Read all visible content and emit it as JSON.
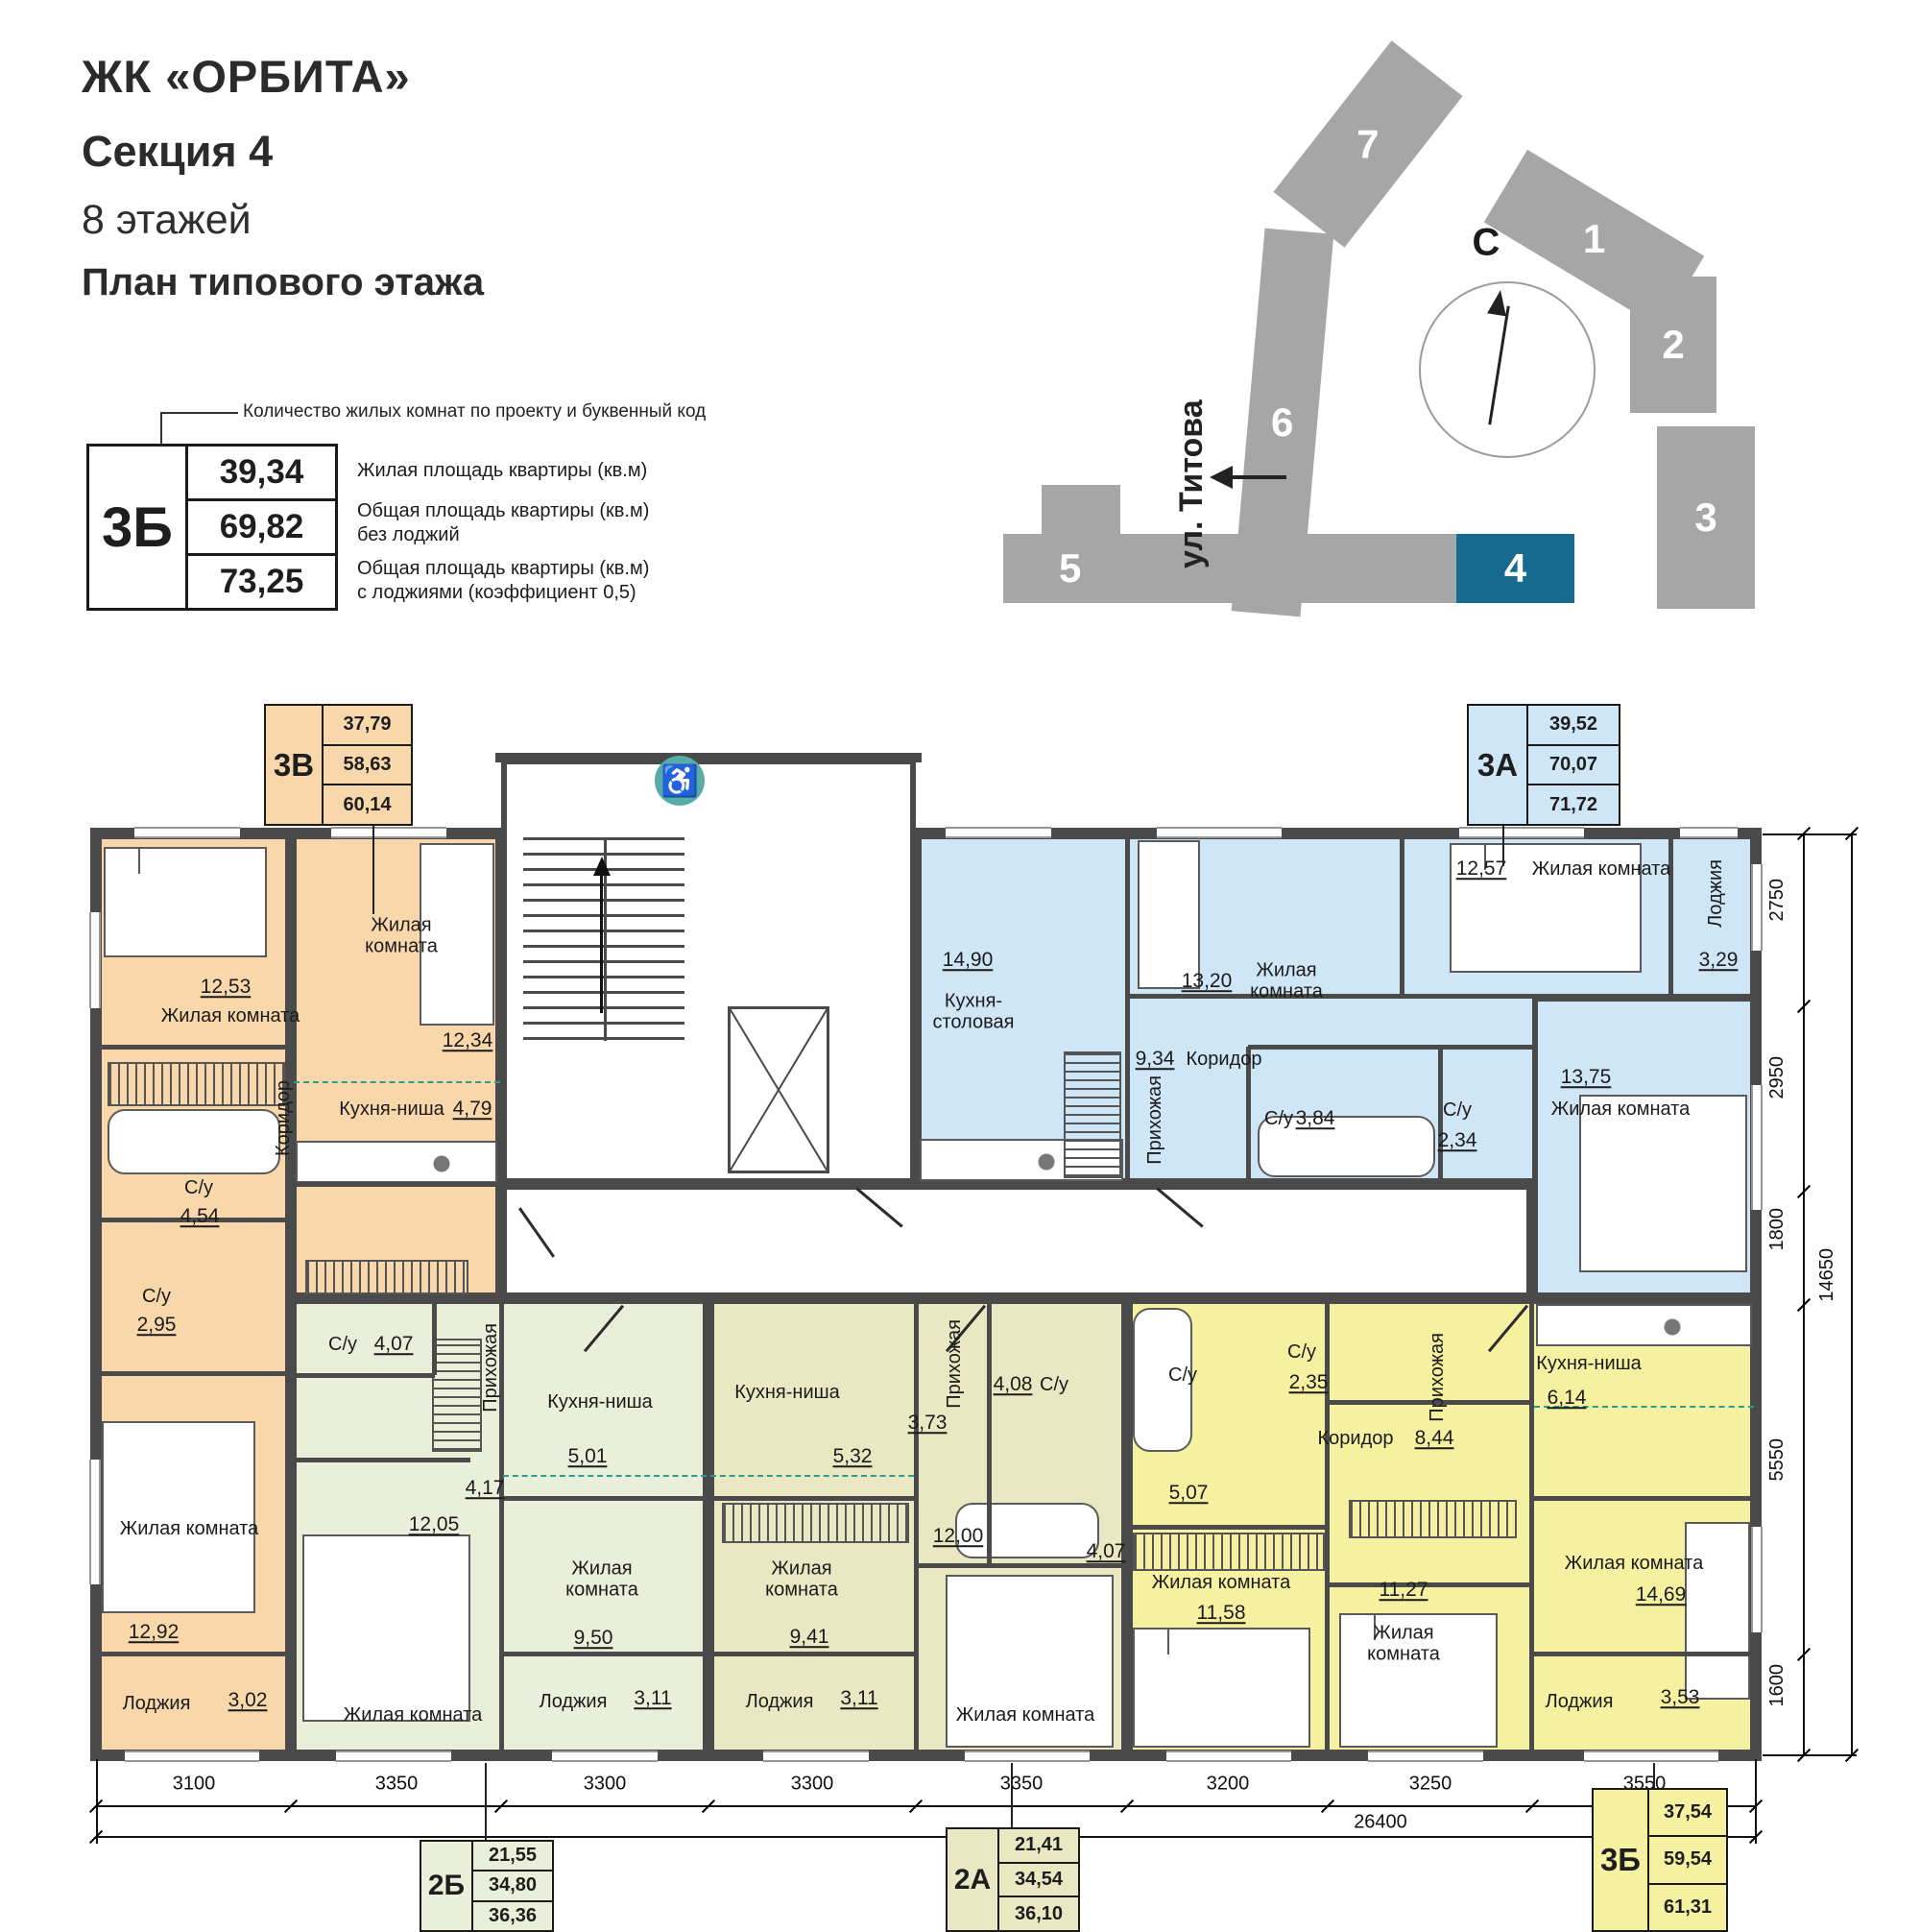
{
  "header": {
    "project": "ЖК «ОРБИТА»",
    "section": "Секция 4",
    "floors": "8 этажей",
    "subtitle": "План типового этажа"
  },
  "legend": {
    "callout": "Количество жилых комнат по проекту и буквенный код",
    "code": "3Б",
    "values": [
      "39,34",
      "69,82",
      "73,25"
    ],
    "descriptions": [
      "Жилая площадь квартиры (кв.м)",
      "Общая площадь квартиры (кв.м)\nбез лоджий",
      "Общая площадь квартиры (кв.м)\nс лоджиями (коэффициент 0,5)"
    ]
  },
  "site_plan": {
    "north": "С",
    "street": "ул. Титова",
    "buildings": [
      "7",
      "6",
      "1",
      "2",
      "3",
      "5",
      "4"
    ],
    "highlighted_building": "4"
  },
  "plan": {
    "apartments": [
      {
        "code": "3В",
        "stats": [
          "37,79",
          "58,63",
          "60,14"
        ],
        "labels": [
          "12,53",
          "Жилая комната",
          "Жилая\nкомната",
          "12,34",
          "Кухня-ниша",
          "4,79",
          "Коридор",
          "С/у",
          "4,54",
          "С/у",
          "2,95",
          "Жилая комната",
          "12,92",
          "Лоджия",
          "3,02"
        ]
      },
      {
        "code": "3А",
        "stats": [
          "39,52",
          "70,07",
          "71,72"
        ],
        "labels": [
          "14,90",
          "Кухня-\nстоловая",
          "13,20",
          "Жилая\nкомната",
          "12,57",
          "Жилая комната",
          "Лоджия",
          "3,29",
          "9,34",
          "Коридор",
          "Прихожая",
          "С/у",
          "3,84",
          "С/у",
          "2,34",
          "13,75",
          "Жилая комната"
        ]
      },
      {
        "code": "2Б",
        "stats": [
          "21,55",
          "34,80",
          "36,36"
        ],
        "labels": [
          "С/у",
          "4,07",
          "Прихожая",
          "4,17",
          "Кухня-ниша",
          "5,01",
          "12,05",
          "Жилая\nкомната",
          "9,50",
          "Жилая комната",
          "Лоджия",
          "3,11"
        ]
      },
      {
        "code": "2А",
        "stats": [
          "21,41",
          "34,54",
          "36,10"
        ],
        "labels": [
          "Кухня-ниша",
          "5,32",
          "Прихожая",
          "3,73",
          "4,08",
          "С/у",
          "12,00",
          "Жилая\nкомната",
          "9,41",
          "Жилая комната",
          "Лоджия",
          "3,11"
        ]
      },
      {
        "code": "3Б",
        "stats": [
          "37,54",
          "59,54",
          "61,31"
        ],
        "labels": [
          "С/у",
          "5,07",
          "С/у",
          "2,35",
          "Коридор",
          "8,44",
          "Прихожая",
          "Кухня-ниша",
          "6,14",
          "4,07",
          "Жилая комната",
          "11,58",
          "11,27",
          "Жилая\nкомната",
          "Жилая комната",
          "14,69",
          "Лоджия",
          "3,53"
        ]
      }
    ]
  },
  "dimensions": {
    "bottom": [
      "3100",
      "3350",
      "3300",
      "3300",
      "3350",
      "3200",
      "3250",
      "3550"
    ],
    "bottom_total": "26400",
    "right": [
      "2750",
      "2950",
      "1800",
      "5550",
      "1600"
    ],
    "right_total": "14650"
  },
  "icons": {
    "accessibility": "♿"
  },
  "colors": {
    "orange": "#f8d7ab",
    "blue": "#cfe6f6",
    "green": "#e9efd9",
    "olive": "#eae8c2",
    "yellow": "#f6f0a1",
    "wall": "#4a4a4a",
    "sitegray": "#a6a6a6",
    "highlight": "#176b8f",
    "access": "#56aca6",
    "dash": "#2a9d8f"
  }
}
